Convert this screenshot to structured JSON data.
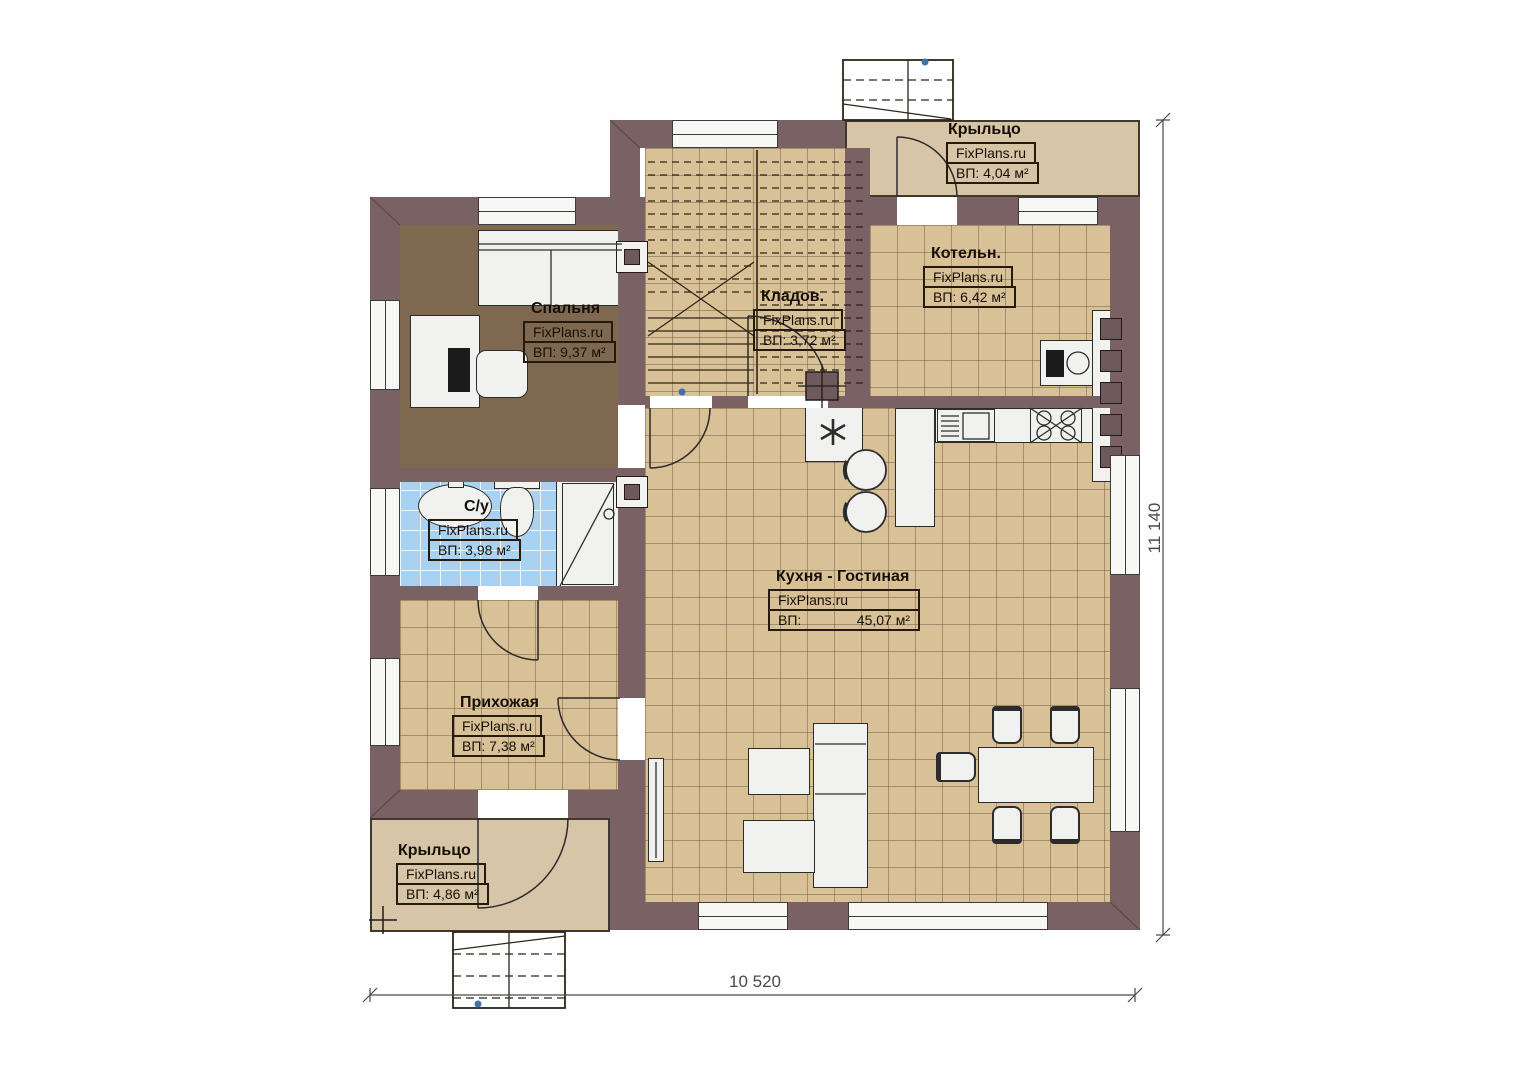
{
  "source_brand": "FixPlans.ru",
  "rooms": {
    "porch_top": {
      "name": "Крыльцо",
      "brand": "FixPlans.ru",
      "area": "ВП: 4,04 м²"
    },
    "boiler": {
      "name": "Котельн.",
      "brand": "FixPlans.ru",
      "area": "ВП: 6,42 м²"
    },
    "bedroom": {
      "name": "Спальня",
      "brand": "FixPlans.ru",
      "area": "ВП: 9,37 м²"
    },
    "storage": {
      "name": "Кладов.",
      "brand": "FixPlans.ru",
      "area": "ВП: 3,72 м²"
    },
    "bathroom": {
      "name": "С/у",
      "brand": "FixPlans.ru",
      "area": "ВП: 3,98 м²"
    },
    "kitchen_living": {
      "name": "Кухня - Гостиная",
      "brand": "FixPlans.ru",
      "area_label": "ВП:",
      "area_value": "45,07 м²"
    },
    "hallway": {
      "name": "Прихожая",
      "brand": "FixPlans.ru",
      "area": "ВП: 7,38 м²"
    },
    "porch_bottom": {
      "name": "Крыльцо",
      "brand": "FixPlans.ru",
      "area": "ВП: 4,86 м²"
    }
  },
  "dimensions": {
    "width": "10 520",
    "height": "11 140"
  },
  "colors": {
    "wall": "#7a6164",
    "floor_tile": "#d8c197",
    "bedroom_floor": "#7e6950",
    "bath_tile": "#a9d2f2",
    "porch": "#d6c5a7",
    "fixture": "#f1f1ef"
  }
}
